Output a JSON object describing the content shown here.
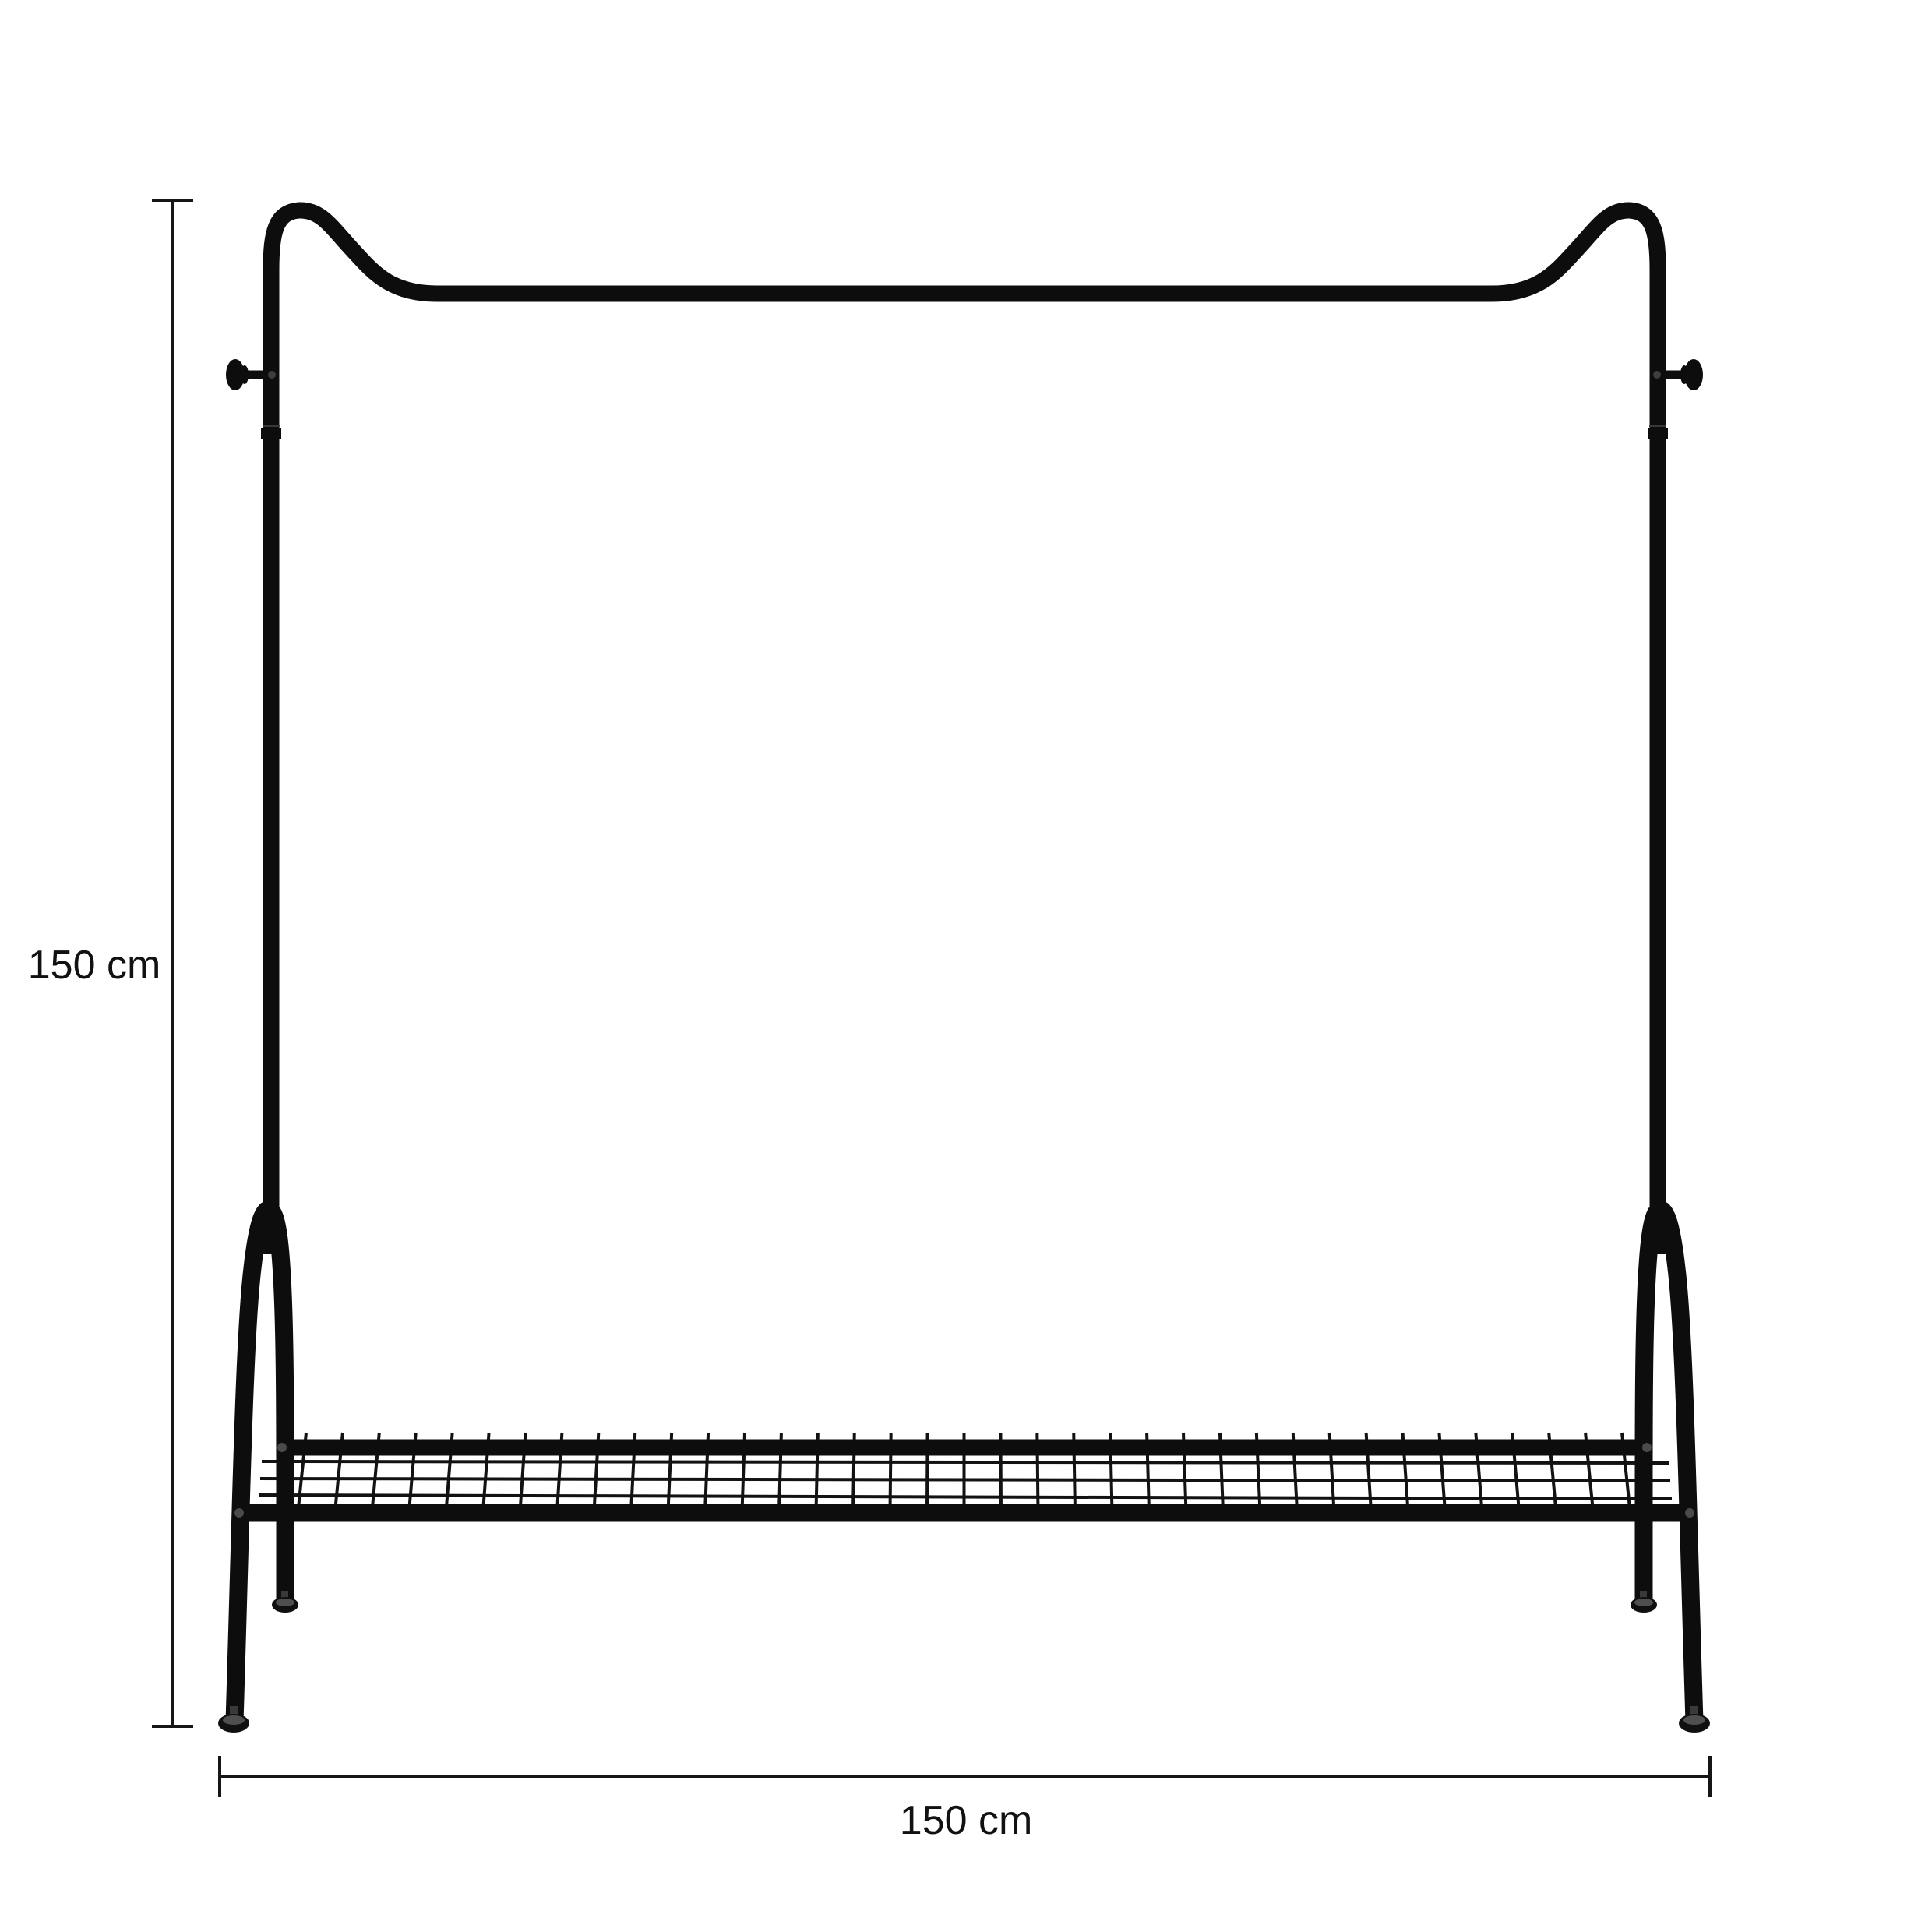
{
  "diagram": {
    "type": "product-dimension-diagram",
    "product": "clothes-rack-with-shelf",
    "background_color": "#ffffff",
    "frame_color": "#0d0d0d",
    "dimension_line_color": "#161616",
    "label_color": "#111111",
    "height_dimension": {
      "label": "150 cm",
      "value": 150,
      "unit": "cm"
    },
    "width_dimension": {
      "label": "150 cm",
      "value": 150,
      "unit": "cm"
    }
  }
}
